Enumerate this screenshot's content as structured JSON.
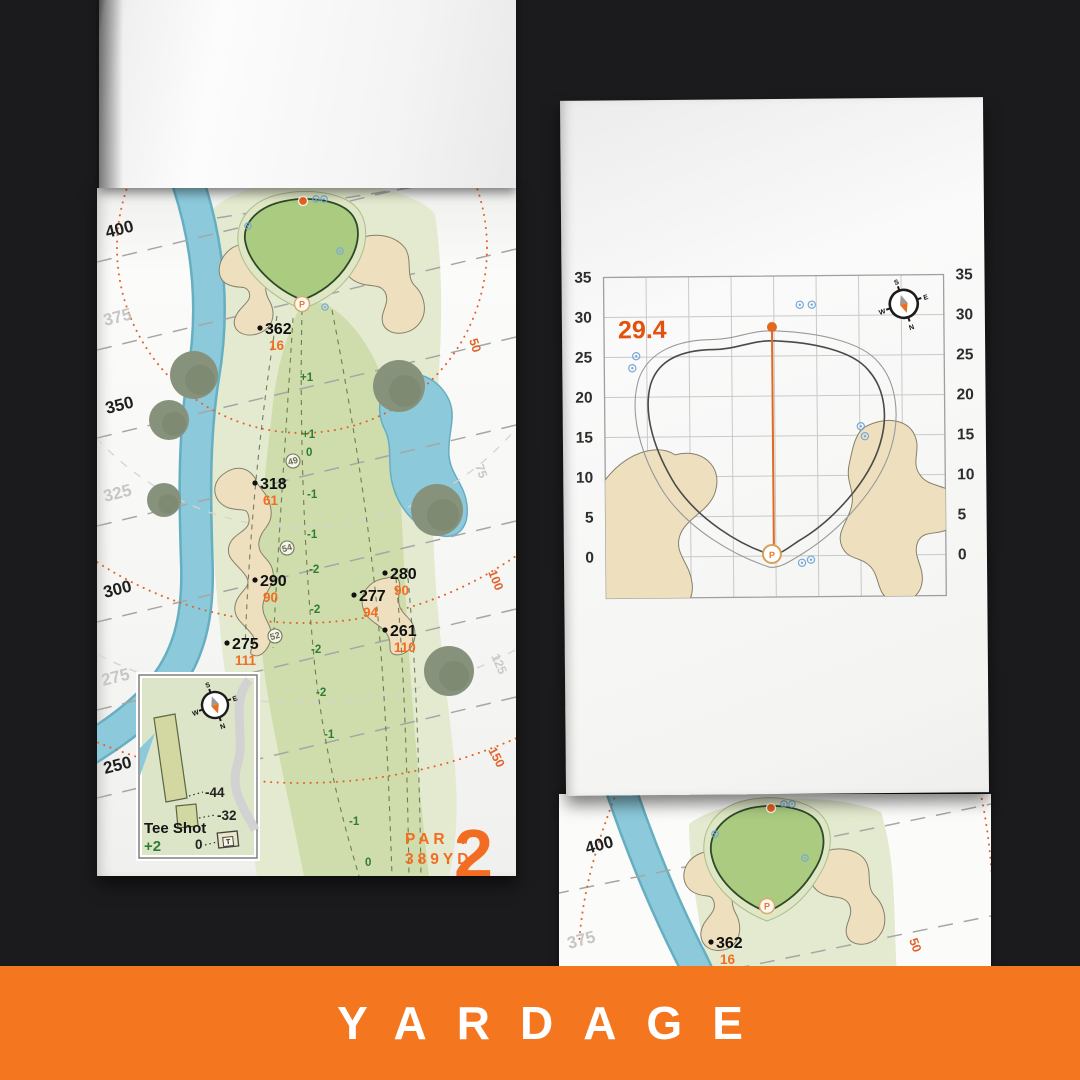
{
  "banner": {
    "label": "YARDAGE"
  },
  "compass": {
    "n": "N",
    "s": "S",
    "e": "E",
    "w": "W"
  },
  "left_page": {
    "hole": {
      "number": "2",
      "par": "PAR 4",
      "yards": "389YD"
    },
    "distance_lines": [
      "400",
      "375",
      "350",
      "325",
      "300",
      "275",
      "250"
    ],
    "arc_labels": {
      "orange": [
        "50",
        "100",
        "150"
      ],
      "gray": [
        "75",
        "125"
      ]
    },
    "yardages": [
      {
        "carry": "362",
        "to_pin": "16"
      },
      {
        "carry": "318",
        "to_pin": "61"
      },
      {
        "carry": "290",
        "to_pin": "90"
      },
      {
        "carry": "280",
        "to_pin": "90"
      },
      {
        "carry": "277",
        "to_pin": "94"
      },
      {
        "carry": "261",
        "to_pin": "110"
      },
      {
        "carry": "275",
        "to_pin": "111"
      }
    ],
    "centerline": [
      "+1",
      "+1",
      "0",
      "-1",
      "-1",
      "-2",
      "-2",
      "-2",
      "-2",
      "-1",
      "-1",
      "0"
    ],
    "waypoints": [
      "49",
      "54",
      "52"
    ],
    "pin": "P",
    "tee_inset": {
      "title": "Tee Shot",
      "elevation": "+2",
      "left_dist": "-44",
      "right_dist": "-32",
      "tee_dist": "0",
      "tee_label": "T"
    }
  },
  "right_page": {
    "depth": "29.4",
    "ticks": [
      "35",
      "30",
      "25",
      "20",
      "15",
      "10",
      "5",
      "0"
    ],
    "pin": "P"
  },
  "next_page": {
    "distance_lines": [
      "400",
      "375"
    ],
    "yardage": {
      "carry": "362",
      "to_pin": "16"
    },
    "arc_label": "50",
    "pin": "P"
  }
}
